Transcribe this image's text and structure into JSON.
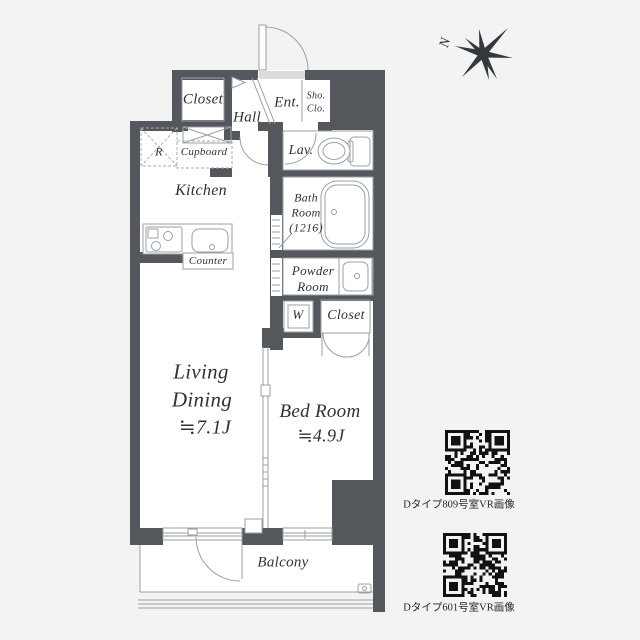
{
  "colors": {
    "background": "#f3f3f4",
    "wall": "#54585c",
    "fixture_line": "#9aa0a5",
    "text": "#2e3237",
    "qr_module": "#111111"
  },
  "compass": {
    "label": "N"
  },
  "floorplan": {
    "rooms": {
      "closet_top": "Closet",
      "hall": "Hall",
      "entrance": "Ent.",
      "shoe_closet_line1": "Sho.",
      "shoe_closet_line2": "Clo.",
      "lavatory": "Lav.",
      "kitchen": "Kitchen",
      "bath_line1": "Bath",
      "bath_line2": "Room",
      "bath_line3": "(1216)",
      "powder_line1": "Powder",
      "powder_line2": "Room",
      "washer": "W",
      "closet_bedroom": "Closet",
      "living_line1": "Living",
      "living_line2": "Dining",
      "living_size": "≒7.1J",
      "bedroom_name": "Bed Room",
      "bedroom_size": "≒4.9J",
      "balcony": "Balcony"
    },
    "fixtures": {
      "refrigerator": "R",
      "cupboard": "Cupboard",
      "counter": "Counter"
    }
  },
  "qr_items": [
    {
      "label": "Dタイプ809号室VR画像"
    },
    {
      "label": "Dタイプ601号室VR画像"
    }
  ]
}
